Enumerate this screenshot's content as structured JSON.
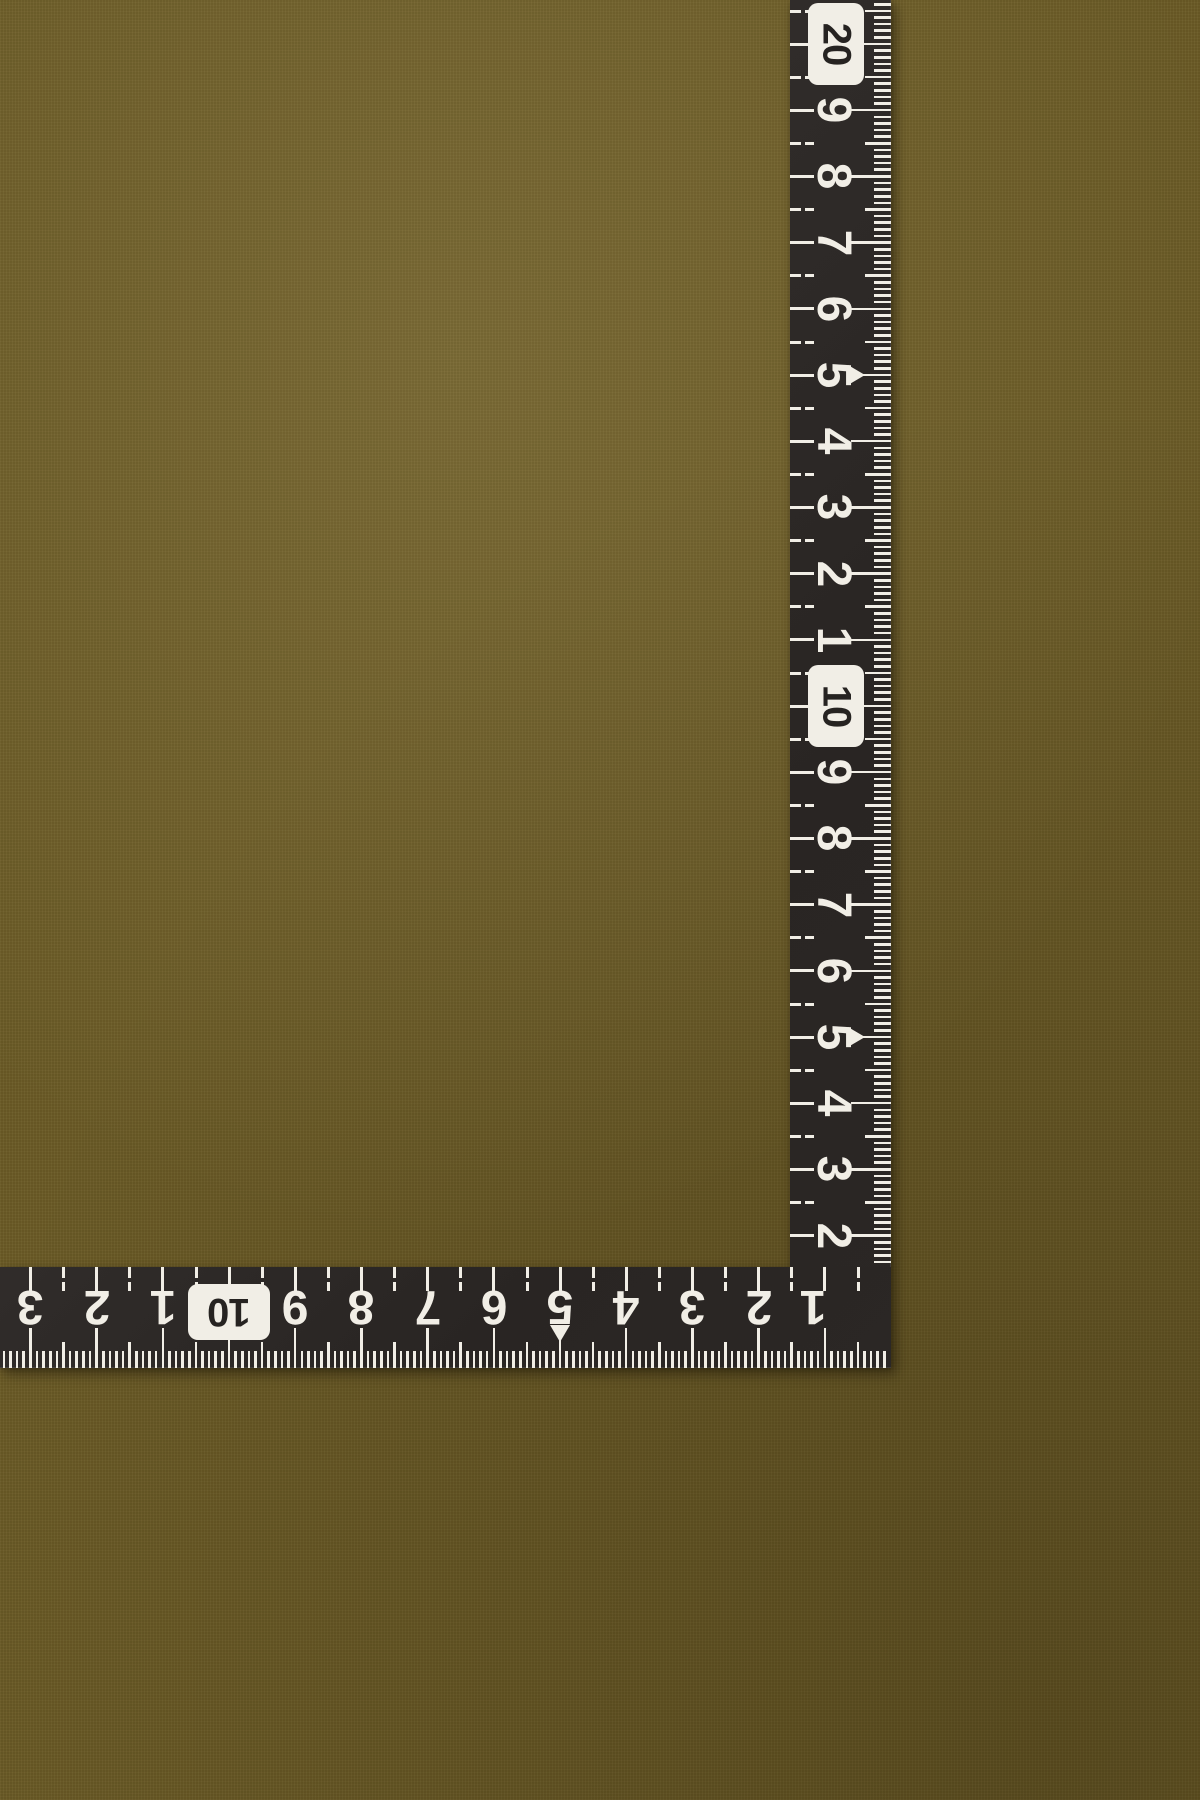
{
  "scene": {
    "fabric_color": "#6b5b26",
    "ruler_color": "#2b2726",
    "marking_color": "#f1eee6"
  },
  "ruler": {
    "kind": "carpenter-l-square",
    "unit": "cm",
    "geometry": {
      "corner_x": 891,
      "corner_y": 1368,
      "cm_px": 66.2,
      "arm_width": 101,
      "vertical_left": 790,
      "horizontal_top": 1267,
      "tick_mm_len": 17,
      "tick_5mm_len": 26,
      "tick_cm_len": 40,
      "edge_cm_len": 24,
      "box_long": 82,
      "box_short": 56
    },
    "vertical_arm": {
      "labels": [
        {
          "cm": 1,
          "text": "1"
        },
        {
          "cm": 2,
          "text": "2"
        },
        {
          "cm": 3,
          "text": "3"
        },
        {
          "cm": 4,
          "text": "4"
        },
        {
          "cm": 5,
          "text": "5"
        },
        {
          "cm": 6,
          "text": "6"
        },
        {
          "cm": 7,
          "text": "7"
        },
        {
          "cm": 8,
          "text": "8"
        },
        {
          "cm": 9,
          "text": "9"
        },
        {
          "cm": 10,
          "text": "10",
          "boxed": true
        },
        {
          "cm": 11,
          "text": "1"
        },
        {
          "cm": 12,
          "text": "2"
        },
        {
          "cm": 13,
          "text": "3"
        },
        {
          "cm": 14,
          "text": "4"
        },
        {
          "cm": 15,
          "text": "5"
        },
        {
          "cm": 16,
          "text": "6"
        },
        {
          "cm": 17,
          "text": "7"
        },
        {
          "cm": 18,
          "text": "8"
        },
        {
          "cm": 19,
          "text": "9"
        },
        {
          "cm": 20,
          "text": "20",
          "boxed": true
        }
      ],
      "arrow_marks_cm": [
        5,
        15
      ]
    },
    "horizontal_arm": {
      "labels": [
        {
          "cm": 1,
          "text": "1"
        },
        {
          "cm": 2,
          "text": "2"
        },
        {
          "cm": 3,
          "text": "3"
        },
        {
          "cm": 4,
          "text": "4"
        },
        {
          "cm": 5,
          "text": "5"
        },
        {
          "cm": 6,
          "text": "6"
        },
        {
          "cm": 7,
          "text": "7"
        },
        {
          "cm": 8,
          "text": "8"
        },
        {
          "cm": 9,
          "text": "9"
        },
        {
          "cm": 10,
          "text": "10",
          "boxed": true
        },
        {
          "cm": 11,
          "text": "1"
        },
        {
          "cm": 12,
          "text": "2"
        },
        {
          "cm": 13,
          "text": "3"
        }
      ],
      "arrow_marks_cm": [
        5
      ]
    }
  }
}
